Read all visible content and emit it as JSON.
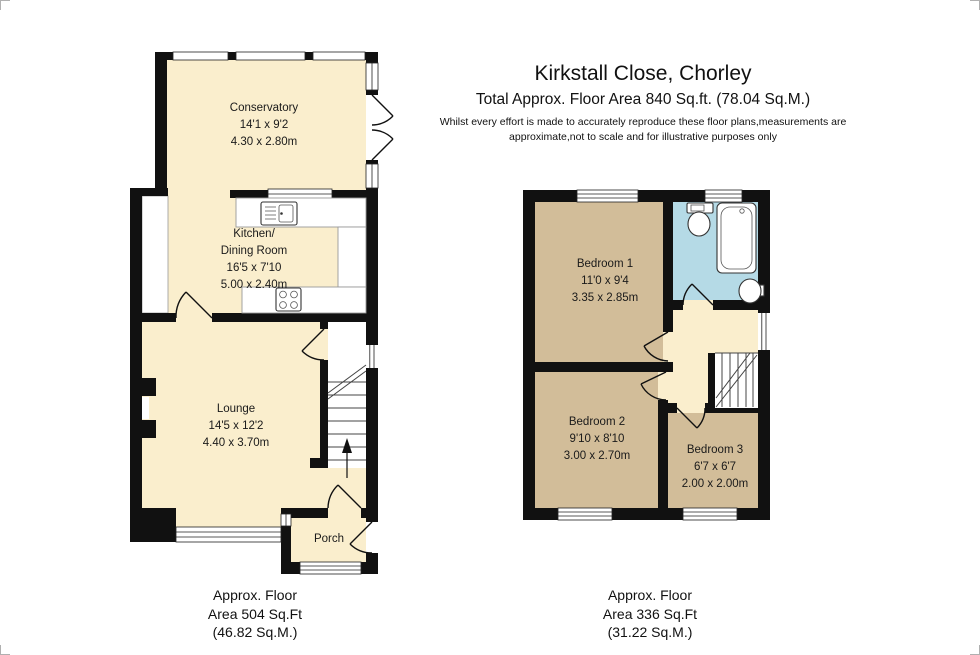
{
  "header": {
    "title": "Kirkstall Close, Chorley",
    "subtitle": "Total Approx. Floor Area 840 Sq.ft. (78.04 Sq.M.)",
    "disclaimer_line1": "Whilst every effort is made to accurately reproduce these floor plans,measurements are",
    "disclaimer_line2": "approximate,not to scale and for illustrative purposes only"
  },
  "ground_floor": {
    "rooms": {
      "conservatory": {
        "name": "Conservatory",
        "imperial": "14'1 x 9'2",
        "metric": "4.30 x 2.80m"
      },
      "kitchen": {
        "name_line1": "Kitchen/",
        "name_line2": "Dining Room",
        "imperial": "16'5 x 7'10",
        "metric": "5.00 x 2.40m"
      },
      "lounge": {
        "name": "Lounge",
        "imperial": "14'5 x 12'2",
        "metric": "4.40 x 3.70m"
      },
      "porch": {
        "name": "Porch"
      }
    },
    "caption": {
      "line1": "Approx. Floor",
      "line2": "Area 504 Sq.Ft",
      "line3": "(46.82 Sq.M.)"
    }
  },
  "first_floor": {
    "rooms": {
      "bedroom1": {
        "name": "Bedroom 1",
        "imperial": "11'0 x 9'4",
        "metric": "3.35 x 2.85m"
      },
      "bedroom2": {
        "name": "Bedroom 2",
        "imperial": "9'10 x 8'10",
        "metric": "3.00 x 2.70m"
      },
      "bedroom3": {
        "name": "Bedroom 3",
        "imperial": "6'7 x 6'7",
        "metric": "2.00 x 2.00m"
      }
    },
    "caption": {
      "line1": "Approx. Floor",
      "line2": "Area 336 Sq.Ft",
      "line3": "(31.22 Sq.M.)"
    }
  },
  "colors": {
    "room_fill_cream": "#faeecd",
    "bedroom_fill_tan": "#d2bd99",
    "bathroom_fill_blue": "#b5dae6",
    "wall_black": "#111111"
  }
}
